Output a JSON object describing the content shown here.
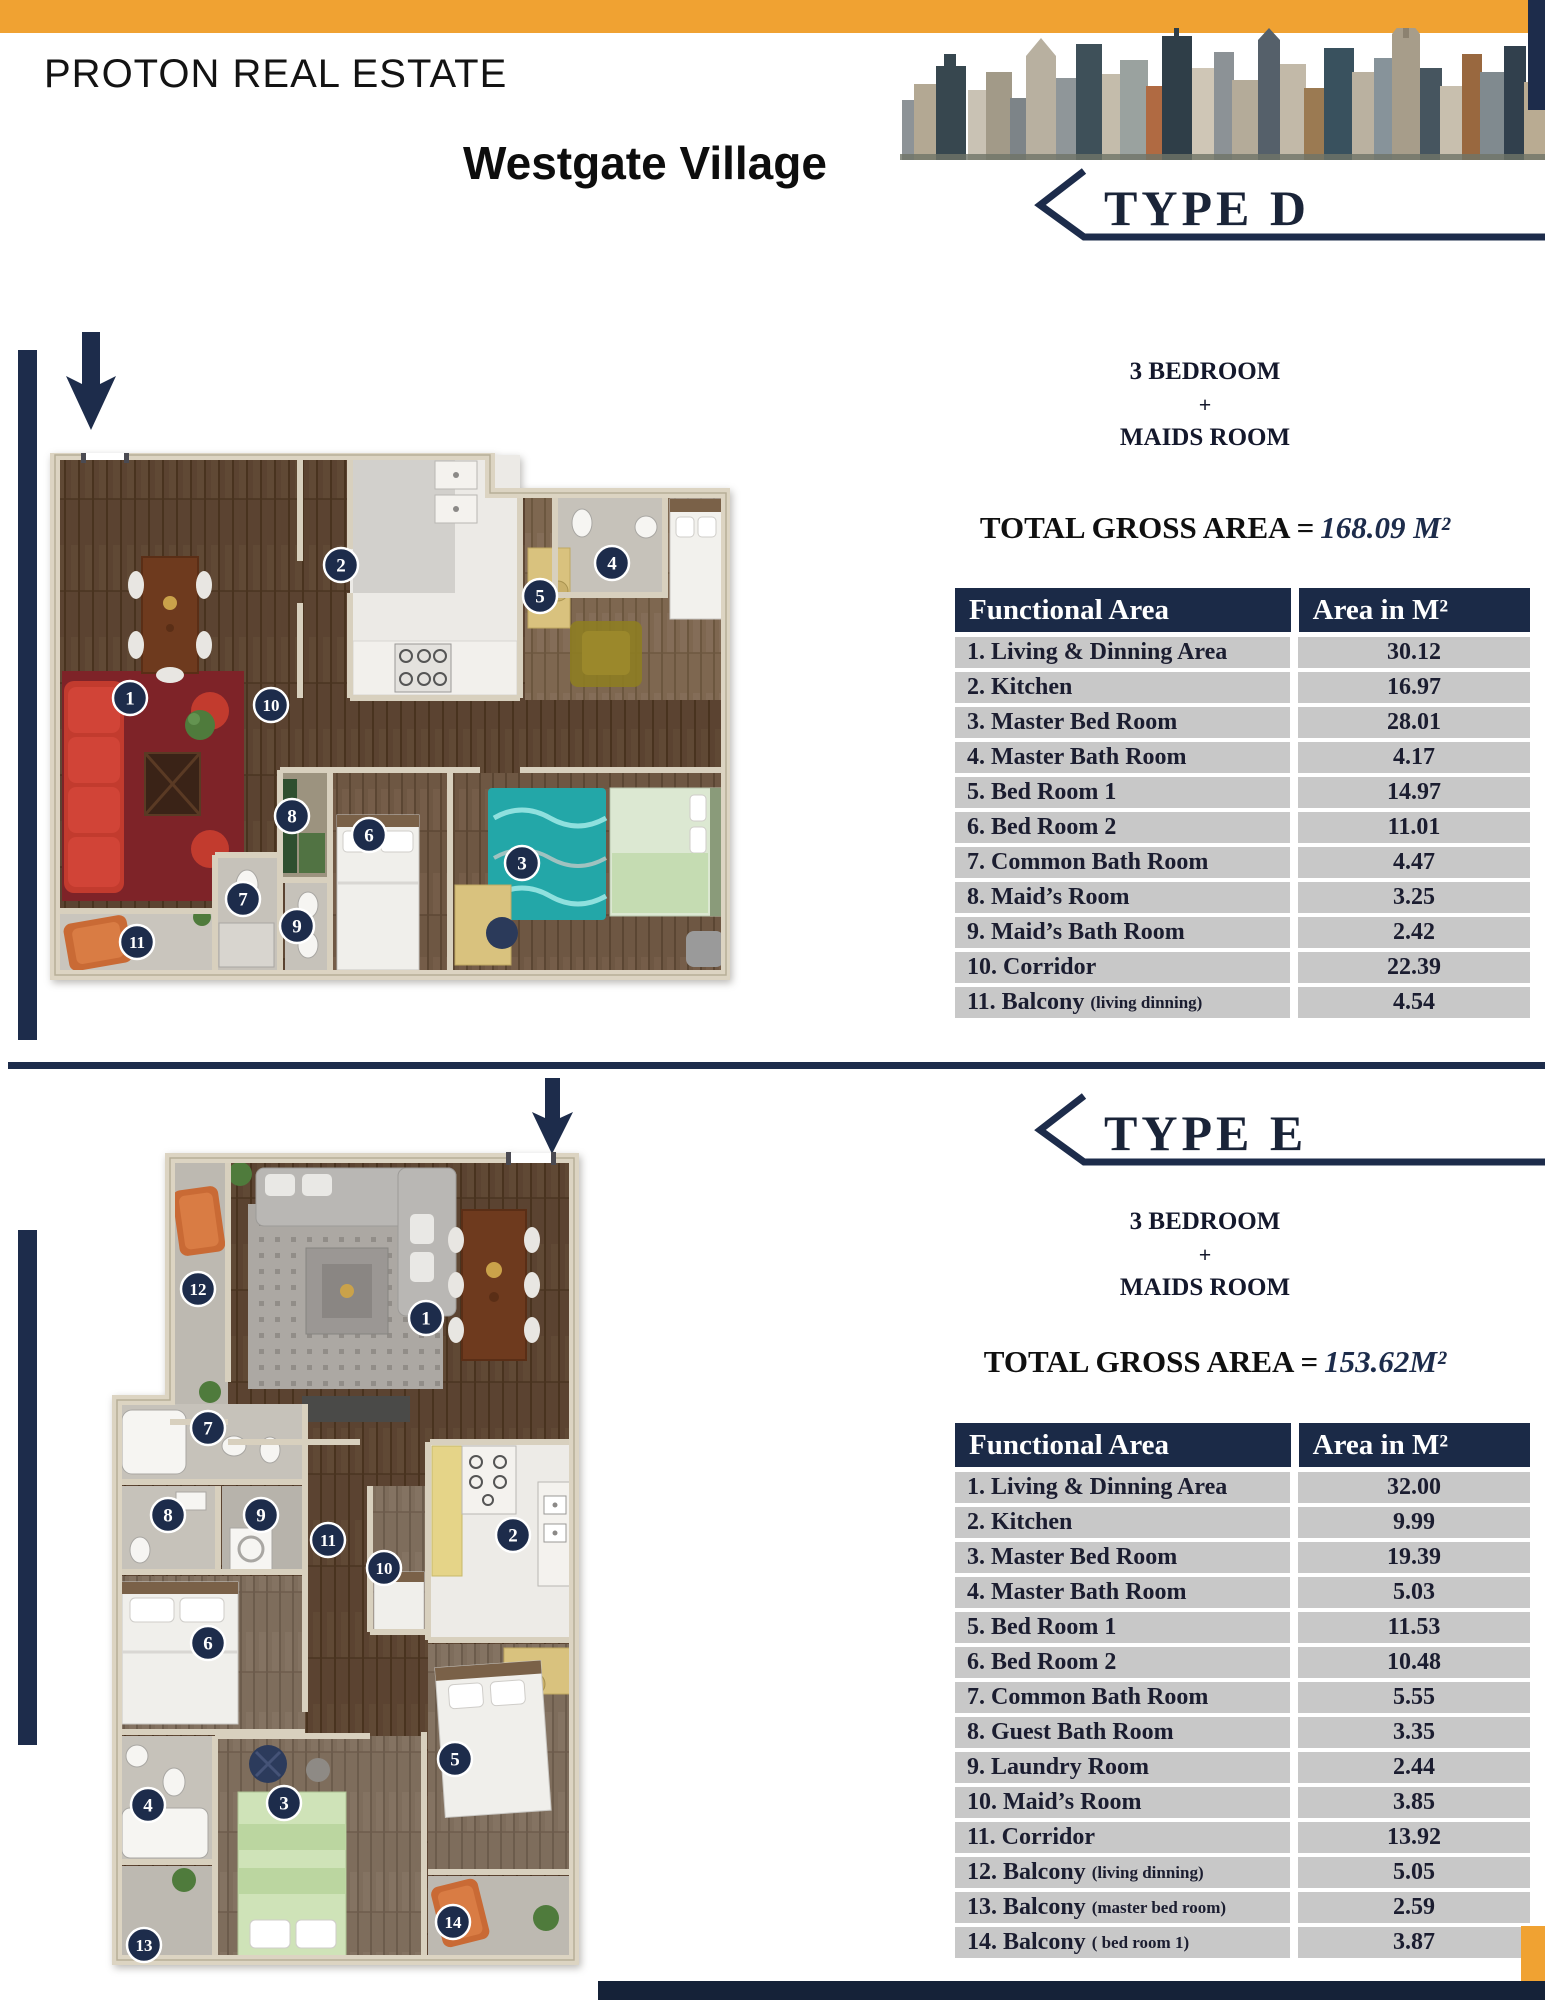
{
  "header": {
    "company": "PROTON REAL ESTATE",
    "project": "Westgate Village"
  },
  "colors": {
    "accent_orange": "#F0A232",
    "navy": "#1D2C4B",
    "table_row_gray": "#C8C8C8"
  },
  "sections": [
    {
      "type_label": "TYPE D",
      "rooms_line1": "3 BEDROOM",
      "rooms_plus": "+",
      "rooms_line2": "MAIDS ROOM",
      "total_label": "TOTAL GROSS AREA =",
      "total_value": "168.09 M²",
      "table": {
        "headers": [
          "Functional Area",
          "Area in M²"
        ],
        "rows": [
          {
            "name": "1. Living & Dinning Area",
            "note": "",
            "area": "30.12"
          },
          {
            "name": "2. Kitchen",
            "note": "",
            "area": "16.97"
          },
          {
            "name": "3. Master Bed Room",
            "note": "",
            "area": "28.01"
          },
          {
            "name": "4. Master Bath Room",
            "note": "",
            "area": "4.17"
          },
          {
            "name": "5. Bed Room 1",
            "note": "",
            "area": "14.97"
          },
          {
            "name": "6. Bed Room 2",
            "note": "",
            "area": "11.01"
          },
          {
            "name": "7. Common Bath Room",
            "note": "",
            "area": "4.47"
          },
          {
            "name": "8. Maid’s Room",
            "note": "",
            "area": "3.25"
          },
          {
            "name": "9. Maid’s Bath Room",
            "note": "",
            "area": "2.42"
          },
          {
            "name": "10. Corridor",
            "note": "",
            "area": "22.39"
          },
          {
            "name": "11. Balcony",
            "note": "(living dinning)",
            "area": "4.54"
          }
        ]
      },
      "badges": [
        "1",
        "2",
        "3",
        "4",
        "5",
        "6",
        "7",
        "8",
        "9",
        "10",
        "11"
      ]
    },
    {
      "type_label": "TYPE E",
      "rooms_line1": "3 BEDROOM",
      "rooms_plus": "+",
      "rooms_line2": "MAIDS ROOM",
      "total_label": "TOTAL GROSS AREA =",
      "total_value": "153.62M²",
      "table": {
        "headers": [
          "Functional Area",
          "Area in M²"
        ],
        "rows": [
          {
            "name": "1. Living & Dinning Area",
            "note": "",
            "area": "32.00"
          },
          {
            "name": "2. Kitchen",
            "note": "",
            "area": "9.99"
          },
          {
            "name": "3. Master Bed Room",
            "note": "",
            "area": "19.39"
          },
          {
            "name": "4. Master Bath Room",
            "note": "",
            "area": "5.03"
          },
          {
            "name": "5. Bed Room 1",
            "note": "",
            "area": "11.53"
          },
          {
            "name": "6. Bed Room 2",
            "note": "",
            "area": "10.48"
          },
          {
            "name": "7. Common Bath Room",
            "note": "",
            "area": "5.55"
          },
          {
            "name": "8. Guest Bath Room",
            "note": "",
            "area": "3.35"
          },
          {
            "name": "9. Laundry Room",
            "note": "",
            "area": "2.44"
          },
          {
            "name": "10. Maid’s Room",
            "note": "",
            "area": "3.85"
          },
          {
            "name": "11. Corridor",
            "note": "",
            "area": "13.92"
          },
          {
            "name": "12. Balcony",
            "note": "(living dinning)",
            "area": "5.05"
          },
          {
            "name": "13. Balcony",
            "note": "(master bed room)",
            "area": "2.59"
          },
          {
            "name": "14. Balcony",
            "note": "( bed room 1)",
            "area": "3.87"
          }
        ]
      },
      "badges": [
        "1",
        "2",
        "3",
        "4",
        "5",
        "6",
        "7",
        "8",
        "9",
        "10",
        "11",
        "12",
        "13",
        "14"
      ]
    }
  ]
}
